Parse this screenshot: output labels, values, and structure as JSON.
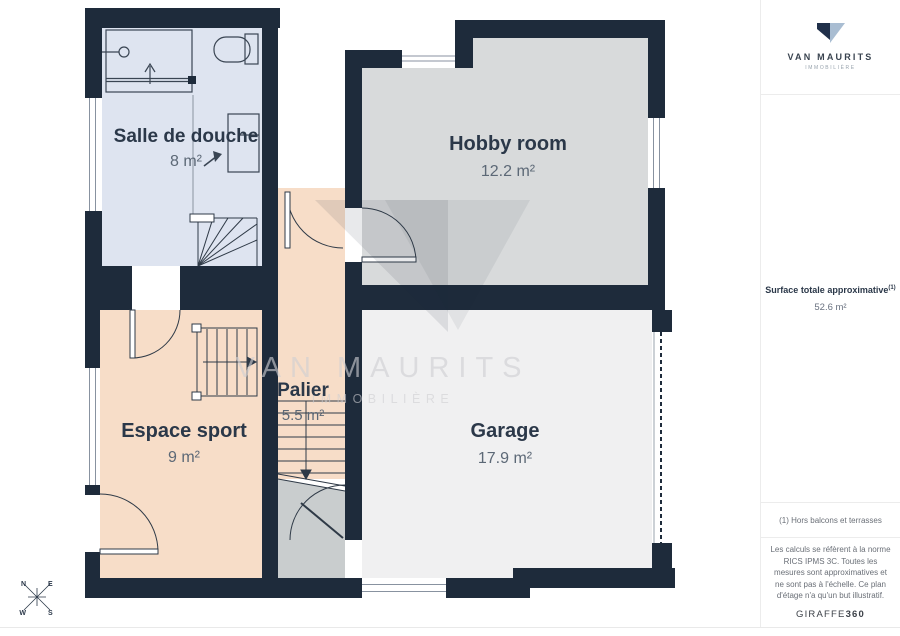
{
  "brand": {
    "name": "VAN MAURITS",
    "tagline": "IMMOBILIÈRE"
  },
  "watermark": {
    "line1": "VAN MAURITS",
    "line2": "IMMOBILIÈRE"
  },
  "rooms": [
    {
      "name": "Salle de douche",
      "area": "8 m²",
      "color": "#dee4f0"
    },
    {
      "name": "Hobby room",
      "area": "12.2 m²",
      "color": "#d8dadb"
    },
    {
      "name": "Espace sport",
      "area": "9 m²",
      "color": "#f7ddc8"
    },
    {
      "name": "Palier",
      "area": "5.5 m²",
      "color": "#f7ddc8"
    },
    {
      "name": "Garage",
      "area": "17.9 m²",
      "color": "#f0f0f1"
    }
  ],
  "sidebar": {
    "surface_label": "Surface totale approximative",
    "surface_sup": "(1)",
    "surface_value": "52.6 m²",
    "footnote": "(1) Hors balcons et terrasses",
    "disclaimer": "Les calculs se réfèrent à la norme RICS IPMS 3C. Toutes les mesures sont approximatives et ne sont pas à l'échelle. Ce plan d'étage n'a qu'un but illustratif.",
    "provider": "GIRAFFE",
    "provider_suffix": "360"
  },
  "compass": {
    "n": "N",
    "e": "E",
    "w": "W",
    "s": "S"
  },
  "colors": {
    "wall": "#1e2b3b",
    "understairs": "#c9cdce",
    "logo_dark": "#20304a",
    "logo_light": "#a9bdd2"
  }
}
